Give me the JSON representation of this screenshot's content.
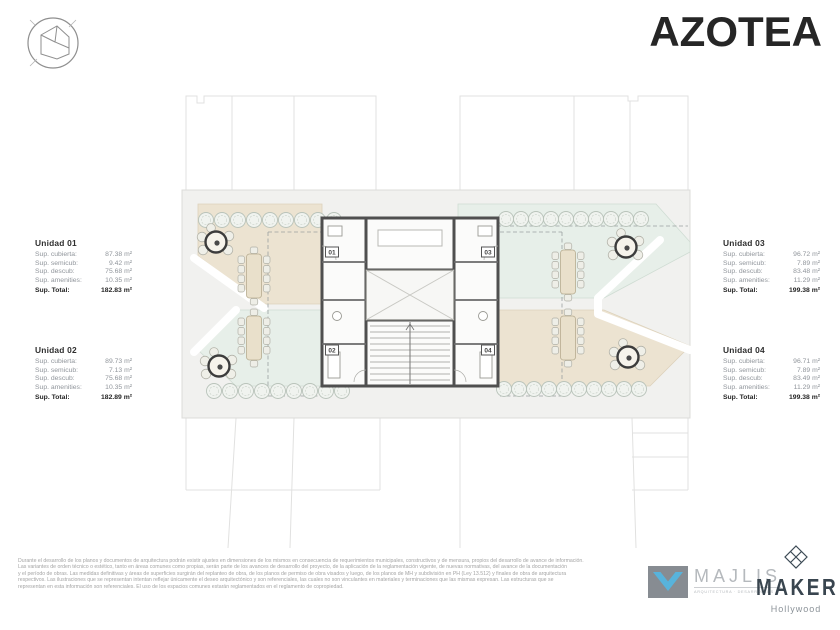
{
  "header": {
    "title": "AZOTEA"
  },
  "units": [
    {
      "name": "Unidad 01",
      "rows": [
        {
          "label": "Sup. cubierta:",
          "value": "87.38 m²"
        },
        {
          "label": "Sup. semicub:",
          "value": "9.42 m²"
        },
        {
          "label": "Sup. descub:",
          "value": "75.68 m²"
        },
        {
          "label": "Sup. amenities:",
          "value": "10.35 m²"
        }
      ],
      "total_label": "Sup. Total:",
      "total_value": "182.83 m²"
    },
    {
      "name": "Unidad 02",
      "rows": [
        {
          "label": "Sup. cubierta:",
          "value": "89.73 m²"
        },
        {
          "label": "Sup. semicub:",
          "value": "7.13 m²"
        },
        {
          "label": "Sup. descub:",
          "value": "75.68 m²"
        },
        {
          "label": "Sup. amenities:",
          "value": "10.35 m²"
        }
      ],
      "total_label": "Sup. Total:",
      "total_value": "182.89 m²"
    },
    {
      "name": "Unidad 03",
      "rows": [
        {
          "label": "Sup. cubierta:",
          "value": "96.72 m²"
        },
        {
          "label": "Sup. semicub:",
          "value": "7.89 m²"
        },
        {
          "label": "Sup. descub:",
          "value": "83.48 m²"
        },
        {
          "label": "Sup. amenities:",
          "value": "11.29 m²"
        }
      ],
      "total_label": "Sup. Total:",
      "total_value": "199.38 m²"
    },
    {
      "name": "Unidad 04",
      "rows": [
        {
          "label": "Sup. cubierta:",
          "value": "96.71 m²"
        },
        {
          "label": "Sup. semicub:",
          "value": "7.89 m²"
        },
        {
          "label": "Sup. descub:",
          "value": "83.49 m²"
        },
        {
          "label": "Sup. amenities:",
          "value": "11.29 m²"
        }
      ],
      "total_label": "Sup. Total:",
      "total_value": "199.38 m²"
    }
  ],
  "plan": {
    "tags": {
      "t1": "01",
      "t2": "02",
      "t3": "03",
      "t4": "04"
    },
    "colors": {
      "terrace_beige": "#ece3d1",
      "terrace_mint": "#e7efe9",
      "slab": "#f1f1ef",
      "wall": "#4f4f4f"
    }
  },
  "footer": {
    "lines": [
      "Durante el desarrollo de los planos y documentos de arquitectura podrán existir ajustes en dimensiones de los mismos en consecuencia de requerimientos municipales, constructivos y de mensura, propios del desarrollo de avance de información.",
      "Las variantes de orden técnico o estético, tanto en áreas comunes como propias, serán parte de los avances de desarrollo del proyecto, de la aplicación de la reglamentación vigente, de nuevas normativas,  del avance de la documentación",
      "y el período de obras. Las medidas definitivas y áreas de superficies surgirán del replanteo de obra, de los planos de permiso de obra visados y luego, de los planos de MH y subdivisión en PH (Ley 13.512) y finales de obra de arquitectura",
      "respectivos. Las ilustraciones que se representan intentan reflejar únicamente el deseo arquitectónico y son referenciales, las cuales no son vinculantes en materiales y terminaciones que las mismas expresan. Las estructuras que se",
      "representan en esta información son referenciales. El uso de los espacios comunes estarán reglamentados en el reglamento de copropiedad."
    ],
    "majlis": {
      "name": "MAJLIS",
      "tagline": "ARQUITECTURA · DESARROLLOS"
    },
    "maker": {
      "name": "MAKER",
      "location": "Hollywood"
    }
  }
}
